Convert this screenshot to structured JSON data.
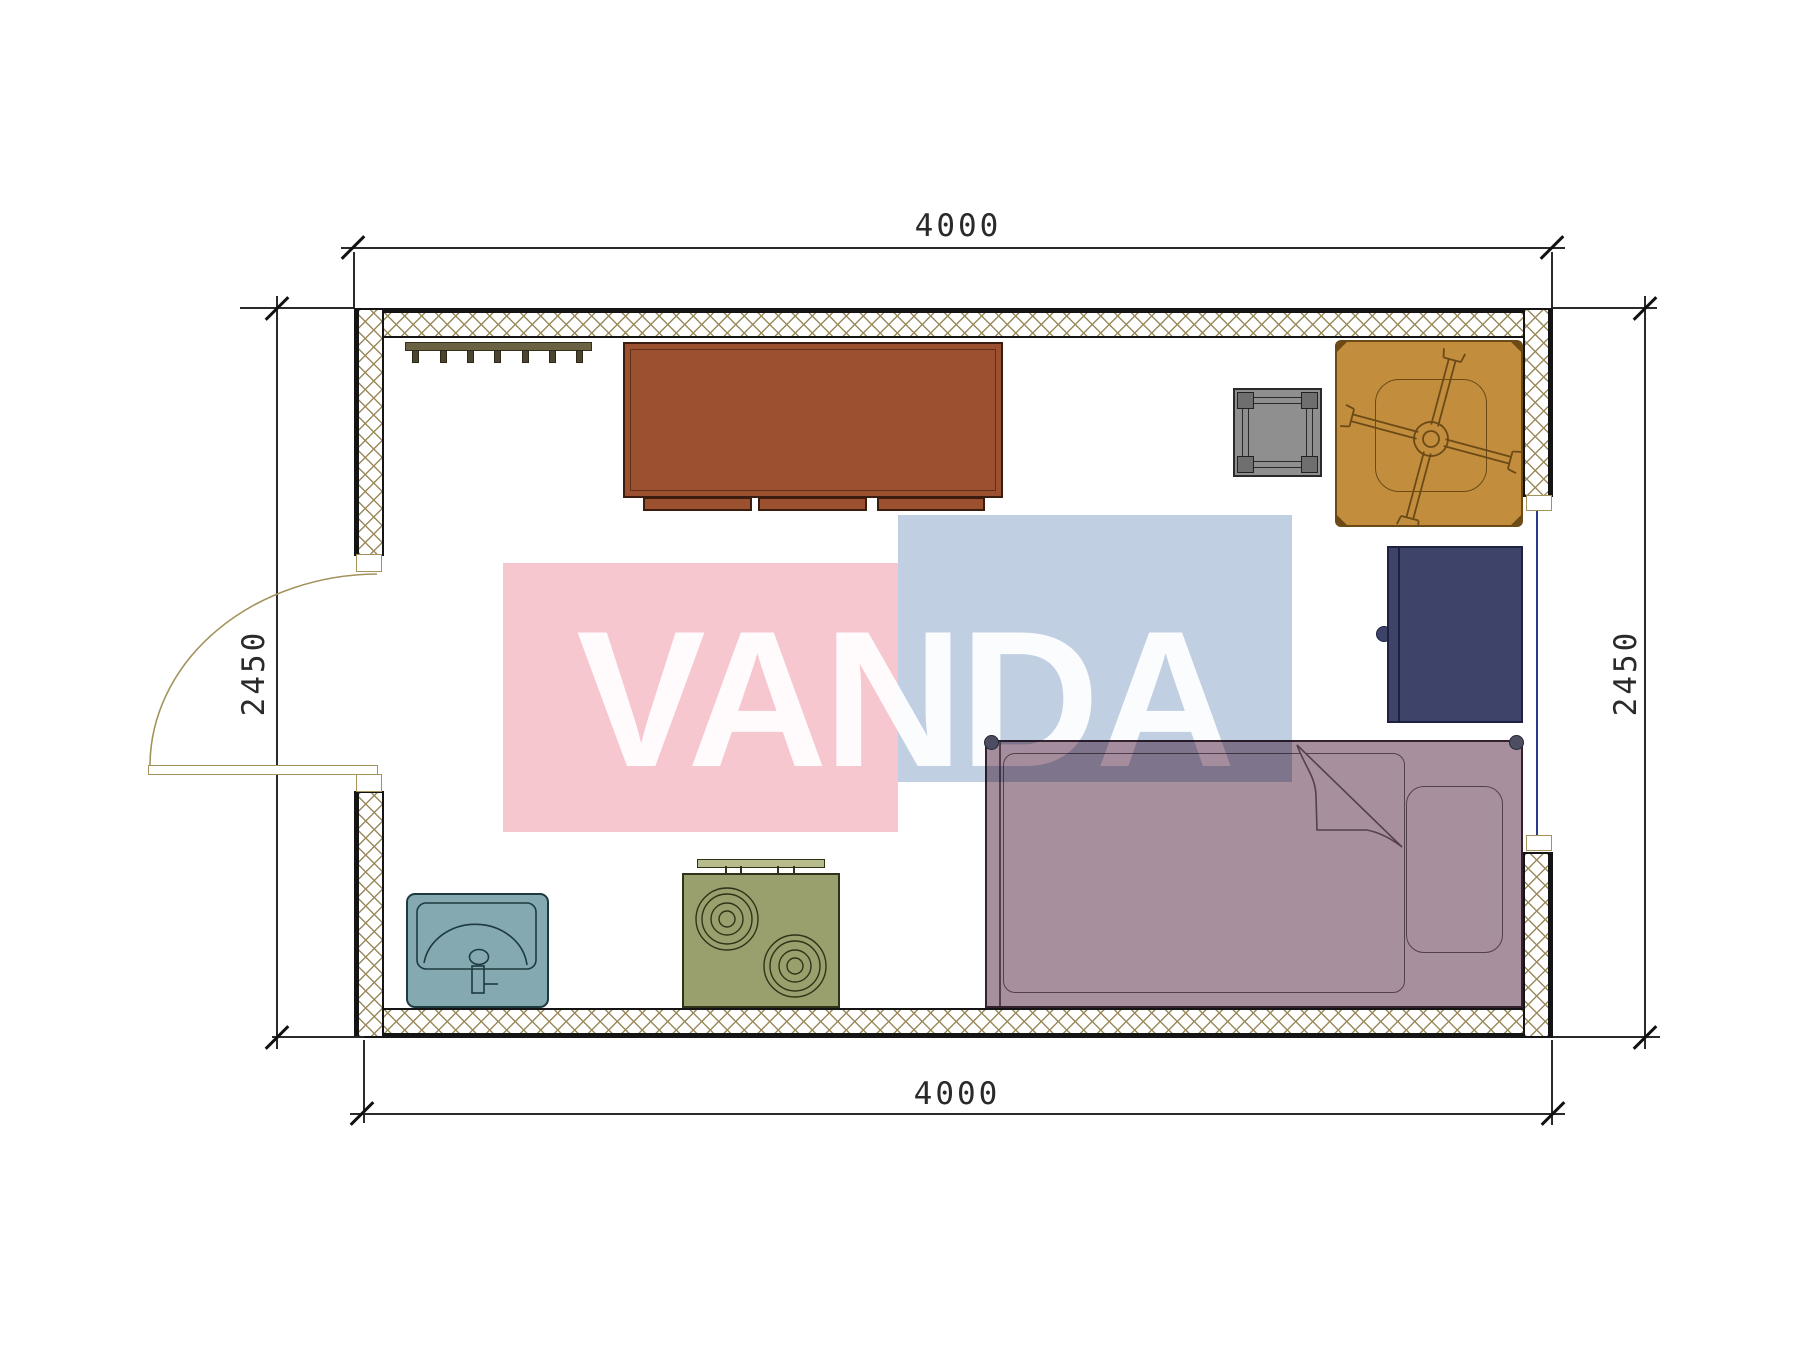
{
  "drawing": {
    "dim_top": "4000",
    "dim_bottom": "4000",
    "dim_left": "2450",
    "dim_right": "2450"
  },
  "watermark": {
    "text": "VANDA",
    "pink": "#f7c7d0",
    "blue": "#c0cfe2"
  },
  "colors": {
    "wall-hatch": "#9a8a5c",
    "wall-line": "#141414",
    "dim-line": "#2a2a2a",
    "desk": "#9b5130",
    "desk-stroke": "#3a1d0e",
    "rack": "#6b6243",
    "stool": "#8f8f8f",
    "stool-dark": "#6f6f6f",
    "chair": "#c28e3e",
    "chair-stroke": "#6b4a16",
    "cabinet": "#3e4469",
    "cabinet-stroke": "#1e2240",
    "bed": "#a88f9e",
    "bed-stroke": "#33222e",
    "bed-line": "#52404c",
    "sink": "#84a9b1",
    "sink-stroke": "#1d3a40",
    "stove": "#9aa06d",
    "stove-stroke": "#2f3318",
    "stove-splash": "#b8bc8c",
    "window-glass": "#2c3a8c",
    "door-line": "#a4925c",
    "wm-pink": "#f7c7d0",
    "wm-blue": "#c0cfe2",
    "wm-text": "rgba(255,255,255,0.93)"
  },
  "symbols": {
    "walls": "hatched-wall",
    "door": "door-swing-left",
    "window": "window-right",
    "coat_rack": "coat-rack-with-hooks",
    "desk": "desk-with-drawers",
    "stool": "square-stool",
    "chair": "swivel-chair",
    "cabinet": "cabinet-fridge",
    "bed": "single-bed-with-pillow",
    "sink": "wash-basin",
    "stove": "two-burner-stove"
  }
}
